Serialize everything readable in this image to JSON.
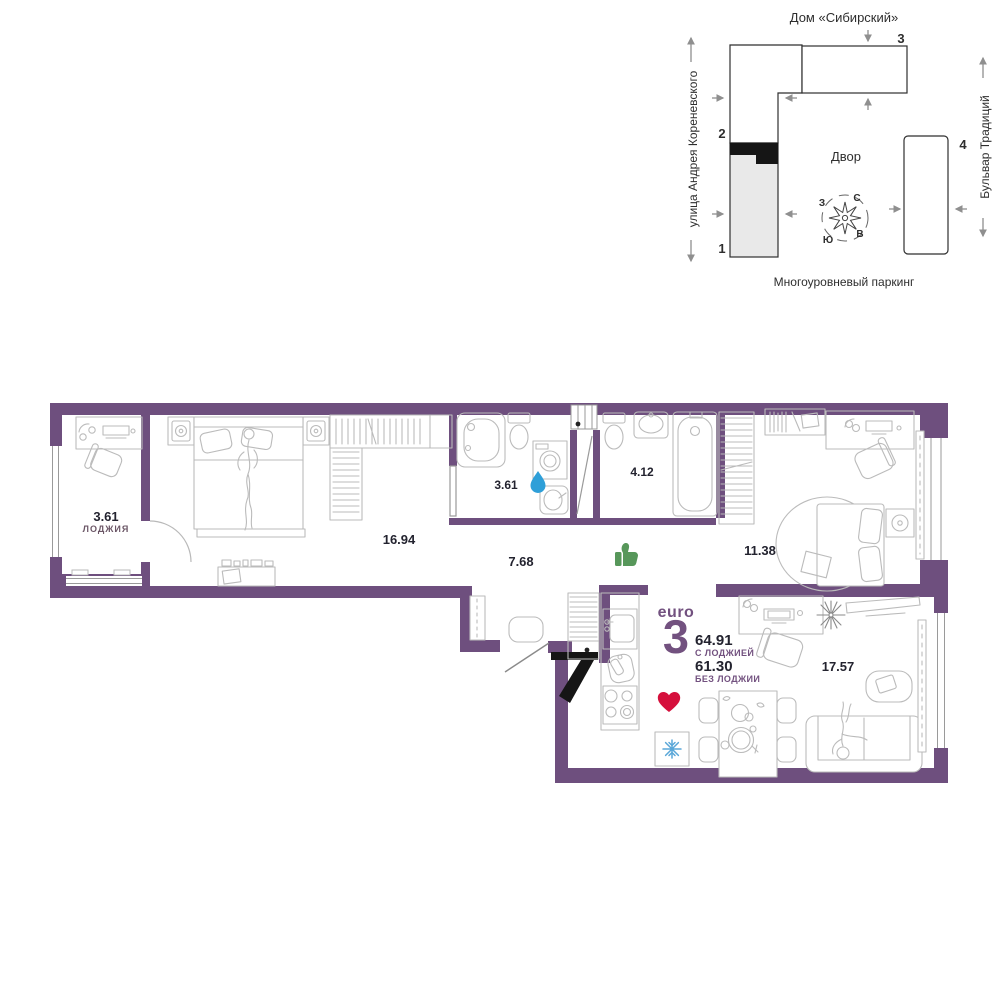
{
  "site_plan": {
    "title": "Дом «Сибирский»",
    "street_left": "улица Андрея Кореневского",
    "street_right": "Бульвар Традиций",
    "courtyard_label": "Двор",
    "parking_label": "Многоуровневый паркинг",
    "building_1": "1",
    "building_2": "2",
    "building_3": "3",
    "building_4": "4",
    "compass": {
      "north": "С",
      "east": "В",
      "south": "Ю",
      "west": "З"
    }
  },
  "apartment": {
    "type_label": "euro",
    "rooms_count": "3",
    "area_with_loggia": "64.91",
    "with_loggia_label": "С ЛОДЖИЕЙ",
    "area_without_loggia": "61.30",
    "without_loggia_label": "БЕЗ ЛОДЖИИ",
    "rooms": {
      "loggia_area": "3.61",
      "loggia_name": "ЛОДЖИЯ",
      "bedroom_area": "16.94",
      "bathroom_small_area": "3.61",
      "hallway_area": "7.68",
      "bathroom_area": "4.12",
      "bedroom2_area": "11.38",
      "living_area": "17.57"
    }
  },
  "colors": {
    "wall_purple": "#6E4F7E",
    "accent_purple": "#72517F",
    "label_dark": "#23232F",
    "water_drop_blue": "#2E9FD8",
    "thumb_green": "#57975A",
    "heart_red": "#D5103C",
    "snowflake_blue": "#5AA7D8"
  }
}
